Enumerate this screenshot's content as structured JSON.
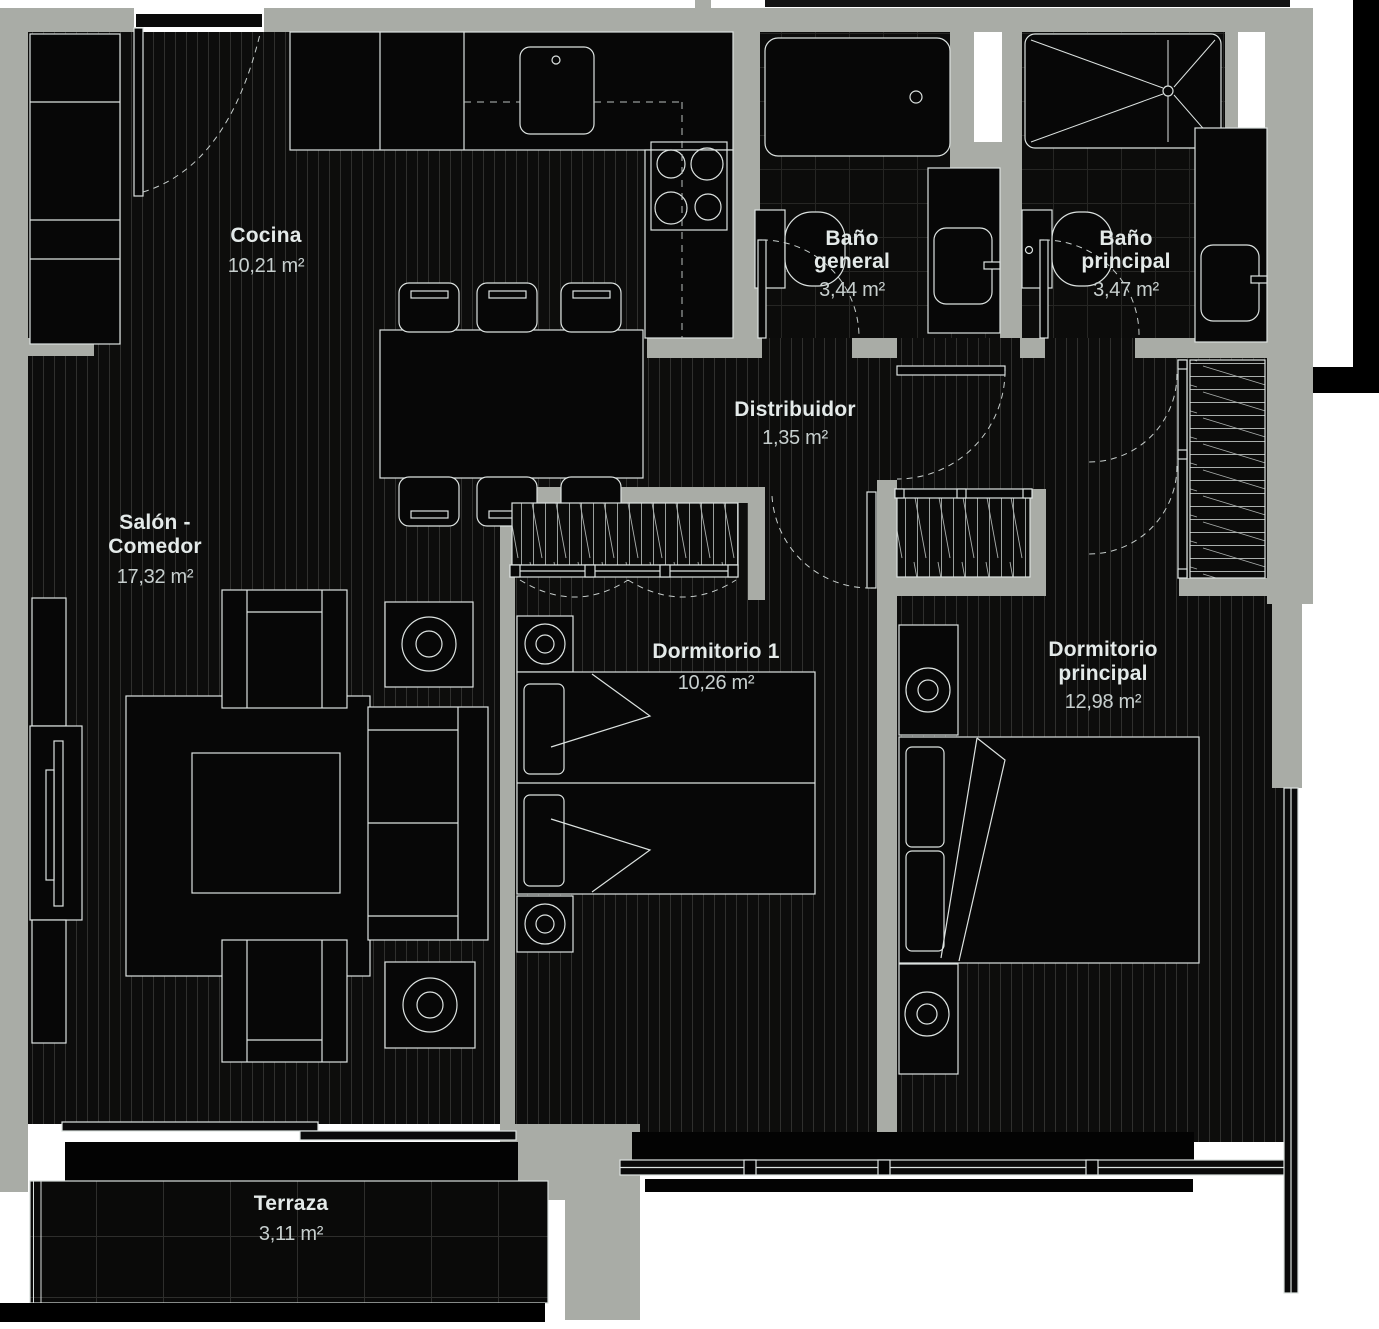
{
  "plan": {
    "rooms": {
      "cocina": {
        "name": "Cocina",
        "area": "10,21 m²"
      },
      "bano_general": {
        "name_line1": "Baño",
        "name_line2": "general",
        "name": "Baño general",
        "area": "3,44 m²"
      },
      "bano_principal": {
        "name_line1": "Baño",
        "name_line2": "principal",
        "name": "Baño principal",
        "area": "3,47 m²"
      },
      "distribuidor": {
        "name": "Distribuidor",
        "area": "1,35 m²"
      },
      "salon_comedor": {
        "name_line1": "Salón -",
        "name_line2": "Comedor",
        "name": "Salón - Comedor",
        "area": "17,32 m²"
      },
      "dormitorio_1": {
        "name": "Dormitorio 1",
        "area": "10,26 m²"
      },
      "dormitorio_principal": {
        "name_line1": "Dormitorio",
        "name_line2": "principal",
        "name": "Dormitorio principal",
        "area": "12,98 m²"
      },
      "terraza": {
        "name": "Terraza",
        "area": "3,11 m²"
      }
    },
    "colors": {
      "wall": "#a9aca6",
      "floor": "#0d0d0c",
      "line": "#dce2e0",
      "room_label": "#e4eae9",
      "area_label": "#c7cfce",
      "background": "#ffffff"
    }
  }
}
